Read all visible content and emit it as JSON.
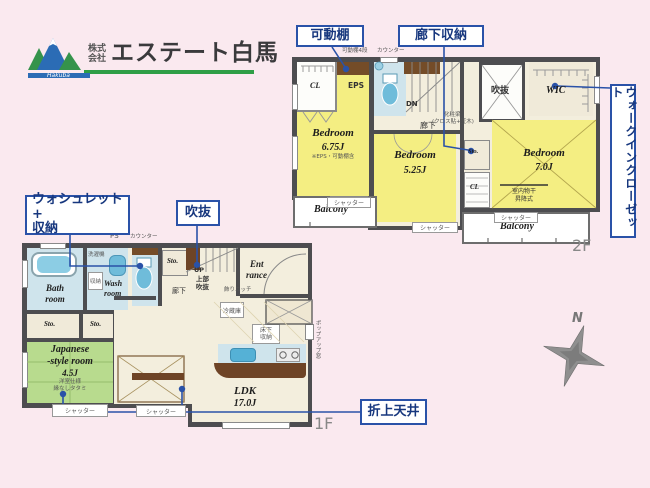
{
  "colors": {
    "background": "#fae9ef",
    "wall": "#4d4d50",
    "accent_blue": "#2a52a8",
    "room_yellow": "#f4ee82",
    "room_green": "#b8db8e",
    "room_blue": "#cfe4ec",
    "floor_beige": "#f3eedd",
    "wood_brown": "#6e4426",
    "logo_green": "#2f9e46",
    "logo_blue": "#2b6cb5"
  },
  "logo": {
    "prefix_top": "株式",
    "prefix_bottom": "会社",
    "name": "エステート白馬",
    "tagline": "Hakuba"
  },
  "callouts": {
    "movable_shelf": "可動棚",
    "hallway_storage": "廊下収納",
    "walk_in_closet": "ウォークインクローゼット",
    "washlet_line1": "ウォシュレット+",
    "washlet_line2": "収納",
    "atrium": "吹抜",
    "coffered_ceiling": "折上天井"
  },
  "shared": {
    "shutter": "シャッター",
    "counter": "カウンター",
    "closet": "CL",
    "storage": "Sto.",
    "balcony": "Balcony",
    "hallway": "廊下"
  },
  "floor2": {
    "label": "2F",
    "movable_shelf_note": "可動棚4段",
    "eps": "EPS",
    "down": "DN",
    "void_room": "吹抜",
    "beam_note1": "化粧梁",
    "beam_note2": "(クロス貼+笠木)",
    "wic": "WIC",
    "bedroom1_name": "Bedroom",
    "bedroom1_size": "6.75J",
    "bedroom1_note": "※EPS・可動棚含",
    "bedroom2_name": "Bedroom",
    "bedroom2_size": "5.25J",
    "bedroom3_name": "Bedroom",
    "bedroom3_size": "7.0J",
    "drying1": "室内物干",
    "drying2": "昇降式"
  },
  "floor1": {
    "label": "1F",
    "ps": "PS",
    "laundry": "洗濯機",
    "bath1": "Bath",
    "bath2": "room",
    "wash1": "Wash",
    "wash2": "room",
    "cabinet": "収納",
    "jp1": "Japanese",
    "jp2": "-style room",
    "jp_size": "4.5J",
    "jp_note1": "洋室仕様",
    "jp_note2": "縁なしタタミ",
    "up": "UP",
    "void1": "上部",
    "void2": "吹抜",
    "ent1": "Ent",
    "ent2": "rance",
    "niche": "飾りニッチ",
    "fridge": "冷蔵庫",
    "underfloor1": "床下",
    "underfloor2": "収納",
    "ldk": "LDK",
    "ldk_size": "17.0J",
    "popup_window": "ポップアップ窓"
  },
  "compass": {
    "north": "N"
  }
}
